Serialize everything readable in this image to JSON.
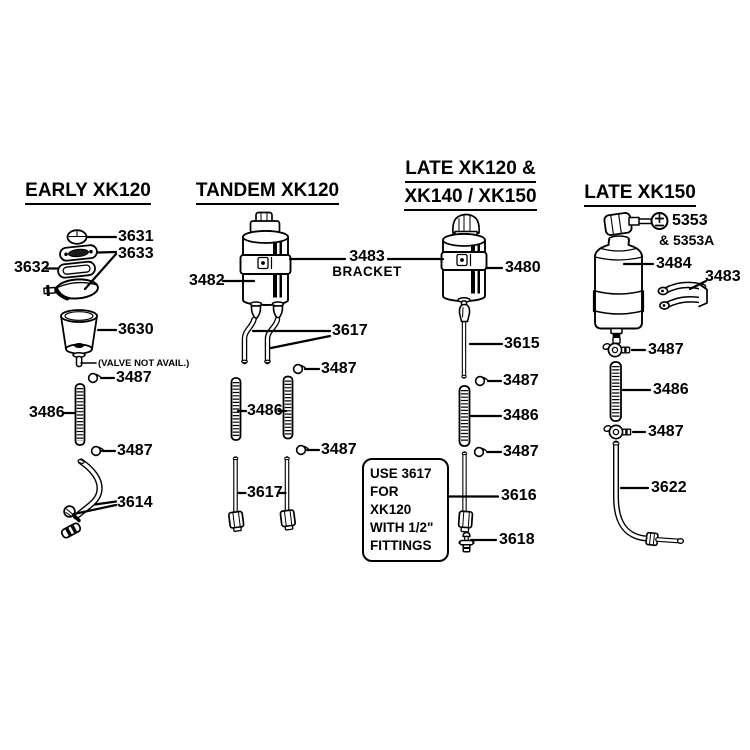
{
  "sections": {
    "early_xk120": {
      "title": "EARLY XK120",
      "parts": {
        "p3631": "3631",
        "p3633": "3633",
        "p3632": "3632",
        "p3630": "3630",
        "valve_note": "(VALVE NOT AVAIL.)",
        "p3487a": "3487",
        "p3486": "3486",
        "p3487b": "3487",
        "p3614": "3614"
      }
    },
    "tandem_xk120": {
      "title": "TANDEM XK120",
      "parts": {
        "p3482": "3482",
        "p3617a": "3617",
        "p3487a": "3487",
        "p3486": "3486",
        "p3487b": "3487",
        "p3617b": "3617"
      }
    },
    "late_xk120_140_150": {
      "title_line1": "LATE XK120 &",
      "title_line2": "XK140 / XK150",
      "bracket": {
        "number": "3483",
        "caption": "BRACKET"
      },
      "parts": {
        "p3480": "3480",
        "p3615": "3615",
        "p3487a": "3487",
        "p3486": "3486",
        "p3487b": "3487",
        "p3616": "3616",
        "p3618": "3618"
      },
      "note_box": {
        "line1": "USE 3617",
        "line2": "FOR XK120",
        "line3": "WITH 1/2\"",
        "line4": "FITTINGS"
      }
    },
    "late_xk150": {
      "title": "LATE XK150",
      "parts": {
        "p5353": "5353",
        "p5353a": "& 5353A",
        "p3484": "3484",
        "p3483": "3483",
        "p3487a": "3487",
        "p3486": "3486",
        "p3487b": "3487",
        "p3622": "3622"
      }
    }
  },
  "colors": {
    "ink": "#000000",
    "background": "#ffffff"
  }
}
